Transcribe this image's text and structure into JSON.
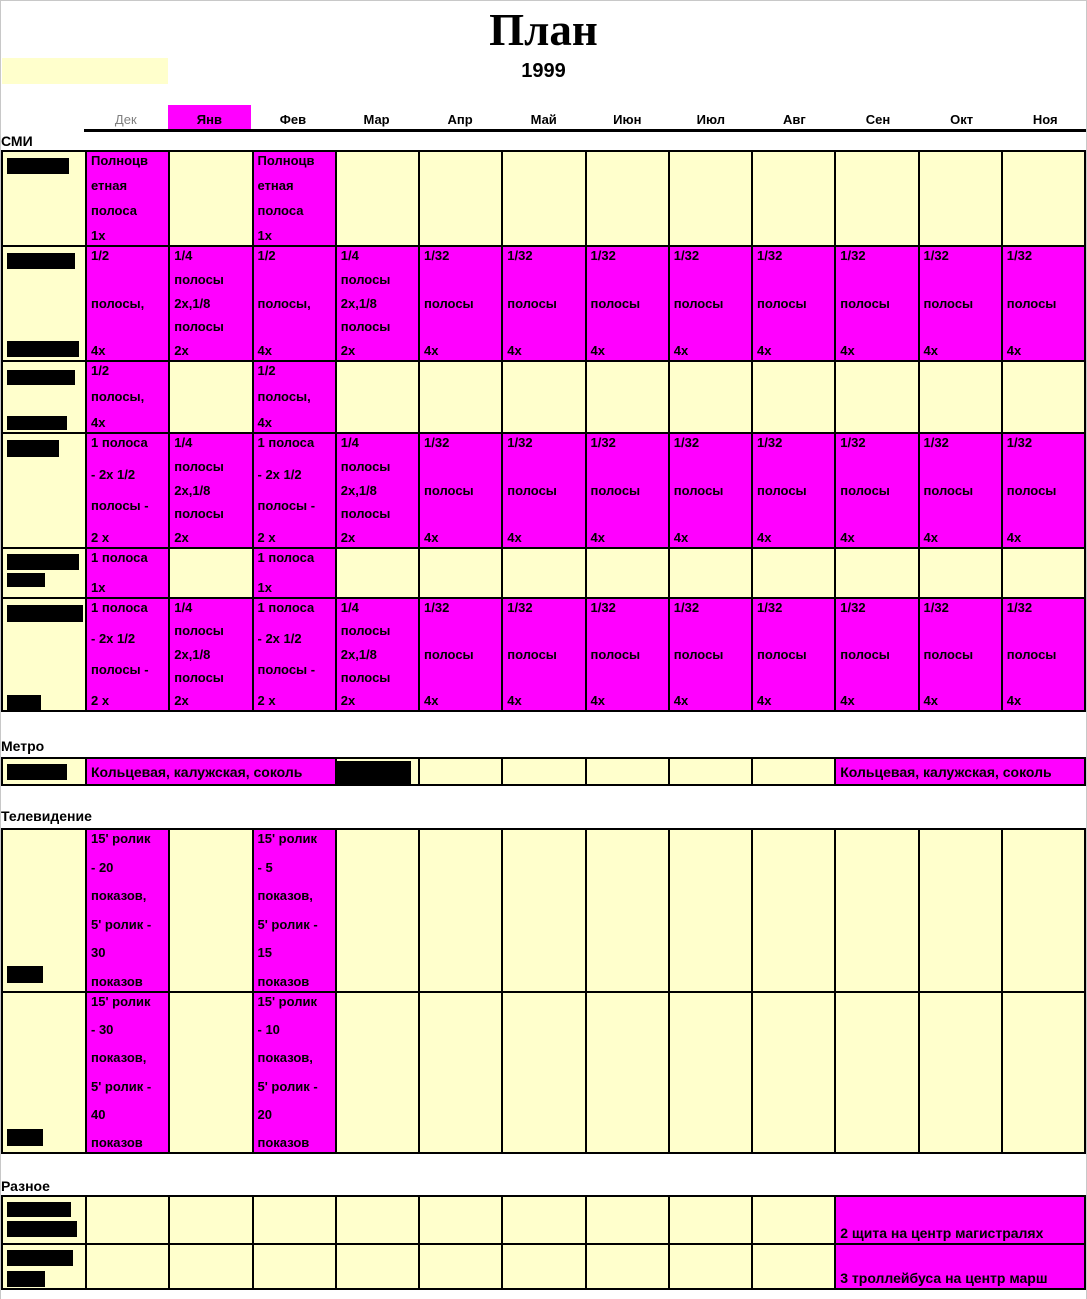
{
  "page": {
    "title": "План",
    "year": "1999"
  },
  "colors": {
    "magenta": "#FF00FF",
    "yellow": "#FFFFCC",
    "dim_month": "#7F7F7F",
    "border": "#000000"
  },
  "months": [
    {
      "label": "Дек",
      "dim": true
    },
    {
      "label": "Янв",
      "highlight": true
    },
    {
      "label": "Фев"
    },
    {
      "label": "Мар"
    },
    {
      "label": "Апр"
    },
    {
      "label": "Май"
    },
    {
      "label": "Июн"
    },
    {
      "label": "Июл"
    },
    {
      "label": "Авг"
    },
    {
      "label": "Сен"
    },
    {
      "label": "Окт"
    },
    {
      "label": "Ноя"
    }
  ],
  "sections": [
    {
      "name": "СМИ",
      "rows": [
        {
          "h": 95,
          "label_bars": [
            {
              "x": 4,
              "y": 6,
              "w": 62,
              "h": 16
            }
          ],
          "cells": [
            {
              "bg": "magenta",
              "lines": [
                "Полноцв",
                "етная",
                "полоса",
                "1х"
              ]
            },
            {
              "bg": "yellow"
            },
            {
              "bg": "magenta",
              "lines": [
                "Полноцв",
                "етная",
                "полоса",
                "1х"
              ]
            },
            {
              "bg": "yellow"
            },
            {
              "bg": "yellow"
            },
            {
              "bg": "yellow"
            },
            {
              "bg": "yellow"
            },
            {
              "bg": "yellow"
            },
            {
              "bg": "yellow"
            },
            {
              "bg": "yellow"
            },
            {
              "bg": "yellow"
            },
            {
              "bg": "yellow"
            }
          ]
        },
        {
          "h": 115,
          "label_bars": [
            {
              "x": 4,
              "y": 6,
              "w": 68,
              "h": 16
            },
            {
              "x": 4,
              "y": 94,
              "w": 72,
              "h": 16
            }
          ],
          "cells": [
            {
              "bg": "magenta",
              "lines": [
                "1/2",
                "полосы,",
                "4х"
              ]
            },
            {
              "bg": "magenta",
              "lines": [
                "1/4",
                "полосы",
                "2х,1/8",
                "полосы",
                "2х"
              ]
            },
            {
              "bg": "magenta",
              "lines": [
                "1/2",
                "полосы,",
                "4х"
              ]
            },
            {
              "bg": "magenta",
              "lines": [
                "1/4",
                "полосы",
                "2х,1/8",
                "полосы",
                "2х"
              ]
            },
            {
              "bg": "magenta",
              "lines": [
                "1/32",
                "полосы",
                "4х"
              ]
            },
            {
              "bg": "magenta",
              "lines": [
                "1/32",
                "полосы",
                "4х"
              ]
            },
            {
              "bg": "magenta",
              "lines": [
                "1/32",
                "полосы",
                "4х"
              ]
            },
            {
              "bg": "magenta",
              "lines": [
                "1/32",
                "полосы",
                "4х"
              ]
            },
            {
              "bg": "magenta",
              "lines": [
                "1/32",
                "полосы",
                "4х"
              ]
            },
            {
              "bg": "magenta",
              "lines": [
                "1/32",
                "полосы",
                "4х"
              ]
            },
            {
              "bg": "magenta",
              "lines": [
                "1/32",
                "полосы",
                "4х"
              ]
            },
            {
              "bg": "magenta",
              "lines": [
                "1/32",
                "полосы",
                "4х"
              ]
            }
          ]
        },
        {
          "h": 72,
          "label_bars": [
            {
              "x": 4,
              "y": 8,
              "w": 68,
              "h": 15
            },
            {
              "x": 4,
              "y": 54,
              "w": 60,
              "h": 14
            }
          ],
          "cells": [
            {
              "bg": "magenta",
              "lines": [
                "1/2",
                "полосы,",
                "4х"
              ]
            },
            {
              "bg": "yellow"
            },
            {
              "bg": "magenta",
              "lines": [
                "1/2",
                "полосы,",
                "4х"
              ]
            },
            {
              "bg": "yellow"
            },
            {
              "bg": "yellow"
            },
            {
              "bg": "yellow"
            },
            {
              "bg": "yellow"
            },
            {
              "bg": "yellow"
            },
            {
              "bg": "yellow"
            },
            {
              "bg": "yellow"
            },
            {
              "bg": "yellow"
            },
            {
              "bg": "yellow"
            }
          ]
        },
        {
          "h": 115,
          "label_bars": [
            {
              "x": 4,
              "y": 6,
              "w": 52,
              "h": 17
            }
          ],
          "cells": [
            {
              "bg": "magenta",
              "lines": [
                "1 полоса",
                "- 2х 1/2",
                "полосы -",
                "2 х"
              ]
            },
            {
              "bg": "magenta",
              "lines": [
                "1/4",
                "полосы",
                "2х,1/8",
                "полосы",
                "2х"
              ]
            },
            {
              "bg": "magenta",
              "lines": [
                "1 полоса",
                "- 2х 1/2",
                "полосы -",
                "2 х"
              ]
            },
            {
              "bg": "magenta",
              "lines": [
                "1/4",
                "полосы",
                "2х,1/8",
                "полосы",
                "2х"
              ]
            },
            {
              "bg": "magenta",
              "lines": [
                "1/32",
                "полосы",
                "4х"
              ]
            },
            {
              "bg": "magenta",
              "lines": [
                "1/32",
                "полосы",
                "4х"
              ]
            },
            {
              "bg": "magenta",
              "lines": [
                "1/32",
                "полосы",
                "4х"
              ]
            },
            {
              "bg": "magenta",
              "lines": [
                "1/32",
                "полосы",
                "4х"
              ]
            },
            {
              "bg": "magenta",
              "lines": [
                "1/32",
                "полосы",
                "4х"
              ]
            },
            {
              "bg": "magenta",
              "lines": [
                "1/32",
                "полосы",
                "4х"
              ]
            },
            {
              "bg": "magenta",
              "lines": [
                "1/32",
                "полосы",
                "4х"
              ]
            },
            {
              "bg": "magenta",
              "lines": [
                "1/32",
                "полосы",
                "4х"
              ]
            }
          ]
        },
        {
          "h": 50,
          "label_bars": [
            {
              "x": 4,
              "y": 5,
              "w": 72,
              "h": 16
            },
            {
              "x": 4,
              "y": 24,
              "w": 38,
              "h": 14
            }
          ],
          "cells": [
            {
              "bg": "magenta",
              "lines": [
                "1 полоса",
                "1х"
              ]
            },
            {
              "bg": "yellow"
            },
            {
              "bg": "magenta",
              "lines": [
                "1 полоса",
                "1х"
              ]
            },
            {
              "bg": "yellow"
            },
            {
              "bg": "yellow"
            },
            {
              "bg": "yellow"
            },
            {
              "bg": "yellow"
            },
            {
              "bg": "yellow"
            },
            {
              "bg": "yellow"
            },
            {
              "bg": "yellow"
            },
            {
              "bg": "yellow"
            },
            {
              "bg": "yellow"
            }
          ]
        },
        {
          "h": 115,
          "label_bars": [
            {
              "x": 4,
              "y": 6,
              "w": 76,
              "h": 17
            },
            {
              "x": 4,
              "y": 96,
              "w": 34,
              "h": 15
            }
          ],
          "cells": [
            {
              "bg": "magenta",
              "lines": [
                "1 полоса",
                "- 2х 1/2",
                "полосы -",
                "2 х"
              ]
            },
            {
              "bg": "magenta",
              "lines": [
                "1/4",
                "полосы",
                "2х,1/8",
                "полосы",
                "2х"
              ]
            },
            {
              "bg": "magenta",
              "lines": [
                "1 полоса",
                "- 2х 1/2",
                "полосы -",
                "2 х"
              ]
            },
            {
              "bg": "magenta",
              "lines": [
                "1/4",
                "полосы",
                "2х,1/8",
                "полосы",
                "2х"
              ]
            },
            {
              "bg": "magenta",
              "lines": [
                "1/32",
                "полосы",
                "4х"
              ]
            },
            {
              "bg": "magenta",
              "lines": [
                "1/32",
                "полосы",
                "4х"
              ]
            },
            {
              "bg": "magenta",
              "lines": [
                "1/32",
                "полосы",
                "4х"
              ]
            },
            {
              "bg": "magenta",
              "lines": [
                "1/32",
                "полосы",
                "4х"
              ]
            },
            {
              "bg": "magenta",
              "lines": [
                "1/32",
                "полосы",
                "4х"
              ]
            },
            {
              "bg": "magenta",
              "lines": [
                "1/32",
                "полосы",
                "4х"
              ]
            },
            {
              "bg": "magenta",
              "lines": [
                "1/32",
                "полосы",
                "4х"
              ]
            },
            {
              "bg": "magenta",
              "lines": [
                "1/32",
                "полосы",
                "4х"
              ]
            }
          ]
        }
      ]
    },
    {
      "name": "Метро",
      "rows": [
        {
          "h": 29,
          "label_bars": [
            {
              "x": 4,
              "y": 5,
              "w": 60,
              "h": 16
            }
          ],
          "cells": [
            {
              "span": 3,
              "bg": "magenta",
              "align": "center",
              "nowrap": true,
              "lines": [
                "Кольцевая, калужская, соколь"
              ]
            },
            {
              "bg": "yellow",
              "bars": [
                {
                  "x": -2,
                  "y": 2,
                  "w": 76,
                  "h": 23
                }
              ]
            },
            {
              "bg": "yellow"
            },
            {
              "bg": "yellow"
            },
            {
              "bg": "yellow"
            },
            {
              "bg": "yellow"
            },
            {
              "bg": "yellow"
            },
            {
              "span": 3,
              "bg": "magenta",
              "align": "center",
              "nowrap": true,
              "lines": [
                "Кольцевая, калужская, соколь"
              ]
            }
          ]
        }
      ]
    },
    {
      "name": "Телевидение",
      "rows": [
        {
          "h": 163,
          "label_bars": [
            {
              "x": 4,
              "y": 136,
              "w": 36,
              "h": 17
            }
          ],
          "cells": [
            {
              "bg": "magenta",
              "lines": [
                "15' ролик",
                "- 20",
                "показов,",
                "5' ролик -",
                "30",
                "показов"
              ]
            },
            {
              "bg": "yellow"
            },
            {
              "bg": "magenta",
              "lines": [
                "15' ролик",
                "- 5",
                "показов,",
                "5' ролик -",
                "15",
                "показов"
              ]
            },
            {
              "bg": "yellow"
            },
            {
              "bg": "yellow"
            },
            {
              "bg": "yellow"
            },
            {
              "bg": "yellow"
            },
            {
              "bg": "yellow"
            },
            {
              "bg": "yellow"
            },
            {
              "bg": "yellow"
            },
            {
              "bg": "yellow"
            },
            {
              "bg": "yellow"
            }
          ]
        },
        {
          "h": 163,
          "label_bars": [
            {
              "x": 4,
              "y": 136,
              "w": 36,
              "h": 17
            }
          ],
          "cells": [
            {
              "bg": "magenta",
              "lines": [
                "15' ролик",
                "- 30",
                "показов,",
                "5' ролик -",
                "40",
                "показов"
              ]
            },
            {
              "bg": "yellow"
            },
            {
              "bg": "magenta",
              "lines": [
                "15' ролик",
                "- 10",
                "показов,",
                "5' ролик -",
                "20",
                "показов"
              ]
            },
            {
              "bg": "yellow"
            },
            {
              "bg": "yellow"
            },
            {
              "bg": "yellow"
            },
            {
              "bg": "yellow"
            },
            {
              "bg": "yellow"
            },
            {
              "bg": "yellow"
            },
            {
              "bg": "yellow"
            },
            {
              "bg": "yellow"
            },
            {
              "bg": "yellow"
            }
          ]
        }
      ]
    },
    {
      "name": "Разное",
      "rows": [
        {
          "h": 48,
          "label_bars": [
            {
              "x": 4,
              "y": 5,
              "w": 64,
              "h": 15
            },
            {
              "x": 4,
              "y": 24,
              "w": 70,
              "h": 16
            }
          ],
          "cells": [
            {
              "bg": "yellow"
            },
            {
              "bg": "yellow"
            },
            {
              "bg": "yellow"
            },
            {
              "bg": "yellow"
            },
            {
              "bg": "yellow"
            },
            {
              "bg": "yellow"
            },
            {
              "bg": "yellow"
            },
            {
              "bg": "yellow"
            },
            {
              "bg": "yellow"
            },
            {
              "span": 3,
              "bg": "magenta",
              "align": "bottom",
              "nowrap": true,
              "lines": [
                "2 щита на центр магистралях"
              ]
            }
          ]
        },
        {
          "h": 47,
          "label_bars": [
            {
              "x": 4,
              "y": 5,
              "w": 66,
              "h": 16
            },
            {
              "x": 4,
              "y": 26,
              "w": 38,
              "h": 16
            }
          ],
          "cells": [
            {
              "bg": "yellow"
            },
            {
              "bg": "yellow"
            },
            {
              "bg": "yellow"
            },
            {
              "bg": "yellow"
            },
            {
              "bg": "yellow"
            },
            {
              "bg": "yellow"
            },
            {
              "bg": "yellow"
            },
            {
              "bg": "yellow"
            },
            {
              "bg": "yellow"
            },
            {
              "span": 3,
              "bg": "magenta",
              "align": "bottom",
              "nowrap": true,
              "lines": [
                "3 троллейбуса на центр марш"
              ]
            }
          ]
        }
      ]
    }
  ]
}
